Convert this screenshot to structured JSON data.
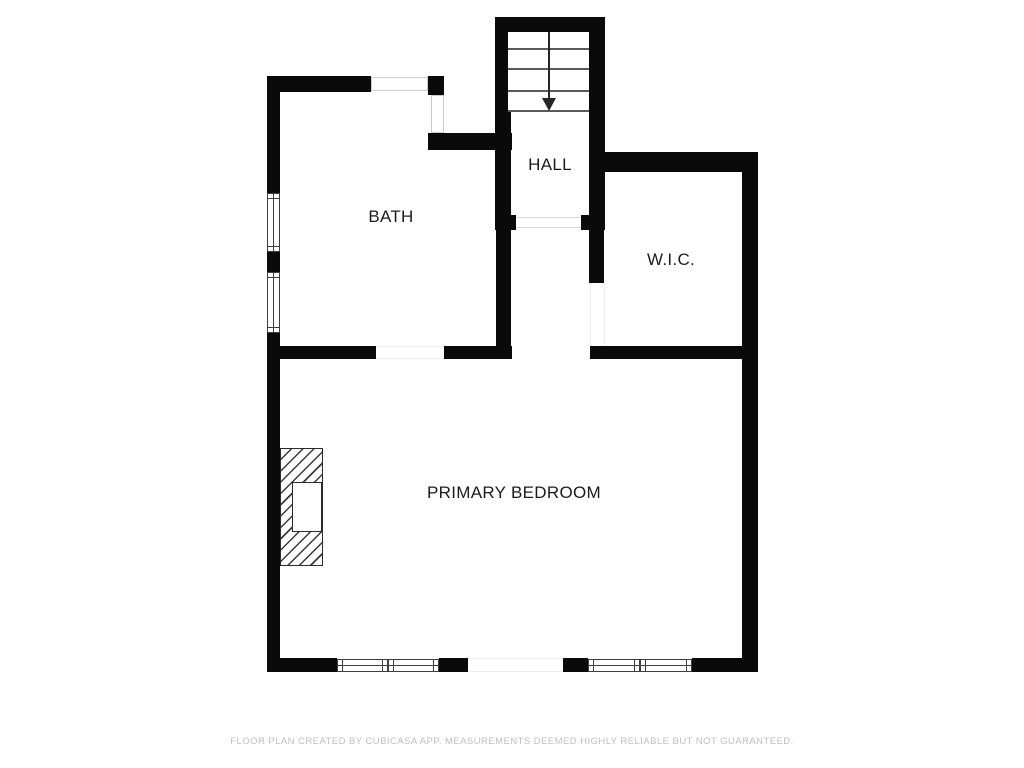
{
  "floorplan": {
    "title": "second floor plan",
    "rooms": [
      {
        "id": "hall",
        "label": "HALL"
      },
      {
        "id": "bath",
        "label": "BATH"
      },
      {
        "id": "wic",
        "label": "W.I.C."
      },
      {
        "id": "primary_bedroom",
        "label": "PRIMARY BEDROOM"
      }
    ],
    "features": [
      {
        "id": "staircase",
        "name": "staircase with downward direction arrow",
        "tread_lines": 4
      },
      {
        "id": "fireplace",
        "name": "hatched fireplace on bedroom left wall"
      },
      {
        "id": "windows",
        "count": 8
      },
      {
        "id": "door_openings",
        "count": 4
      }
    ],
    "colors": {
      "wall": "#0a0a0a",
      "room_label": "#1c1c1c",
      "stair_tread": "#5a5a5a",
      "window_frame": "#3f3f3f",
      "footer_text": "#c0c0c0",
      "background": "#ffffff"
    }
  },
  "footer": {
    "disclaimer": "FLOOR PLAN CREATED BY CUBICASA APP. MEASUREMENTS DEEMED HIGHLY RELIABLE BUT NOT GUARANTEED."
  }
}
